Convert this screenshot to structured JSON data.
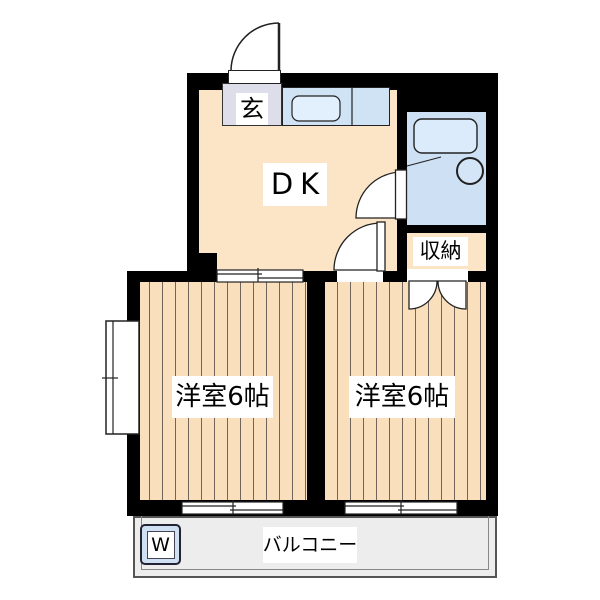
{
  "title": "apartment-floorplan",
  "labels": {
    "entrance": "玄",
    "dining_kitchen": "DK",
    "storage": "収納",
    "room_left": "洋室6帖",
    "room_right": "洋室6帖",
    "balcony": "バルコニー",
    "washer": "W"
  },
  "colors": {
    "wall": "#000000",
    "floor": "#fce4c6",
    "flooring_stripe": "#6f655c",
    "kitchen_counter_blue": "#cfe3f5",
    "bathroom_blue": "#cde0f4",
    "genkan_tile": "#dedeeb",
    "balcony_gray": "#ededed",
    "label_background": "#ffffff"
  }
}
